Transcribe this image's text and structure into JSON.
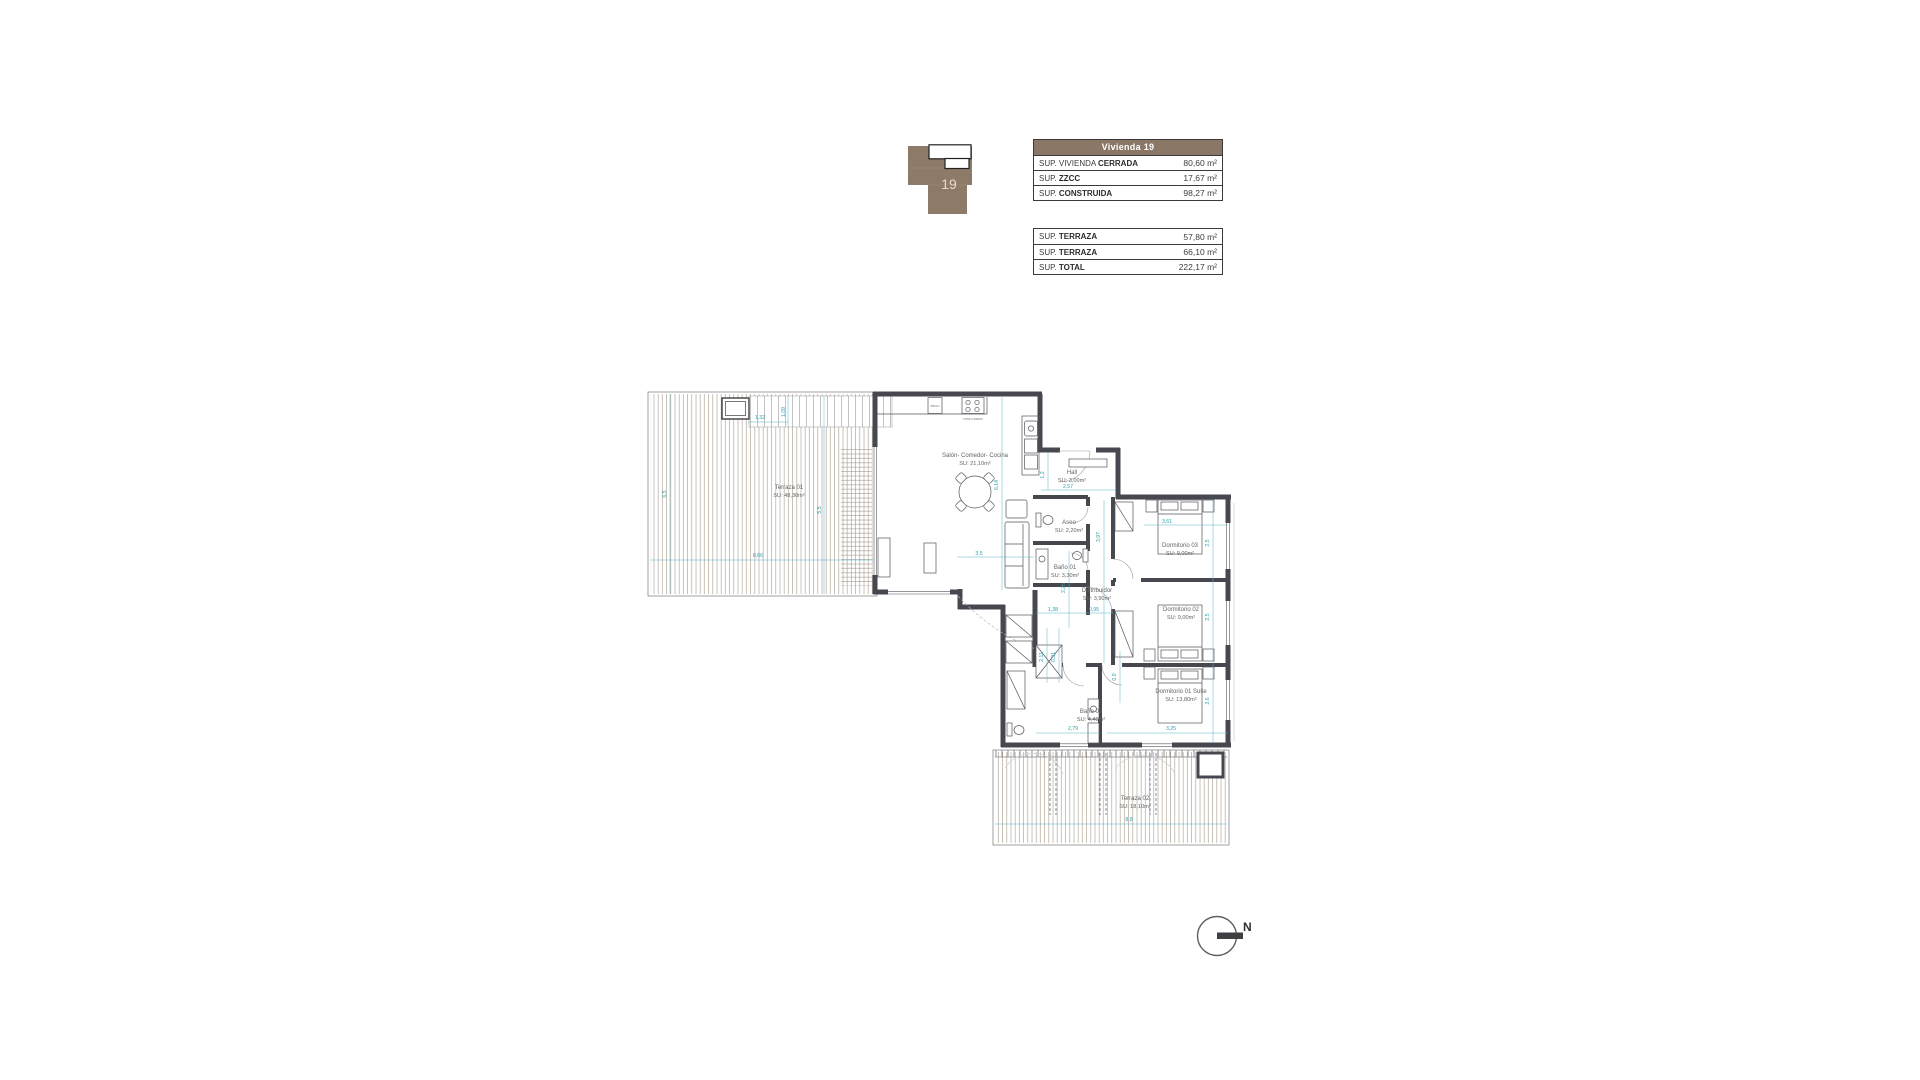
{
  "sheet": {
    "unit_title": "Vivienda 19"
  },
  "key_plan": {
    "unit_number": "19"
  },
  "area_table_1": {
    "header": "Vivienda 19",
    "rows": [
      {
        "label_pre": "SUP. VIVIENDA ",
        "label_bold": "CERRADA",
        "value": "80,60",
        "unit": "m²"
      },
      {
        "label_pre": "SUP. ",
        "label_bold": "ZZCC",
        "value": "17,67",
        "unit": "m²"
      },
      {
        "label_pre": "SUP. ",
        "label_bold": "CONSTRUIDA",
        "value": "98,27",
        "unit": "m²"
      }
    ]
  },
  "area_table_2": {
    "rows": [
      {
        "label_pre": "SUP. ",
        "label_bold": "TERRAZA",
        "value": "57,80",
        "unit": "m²"
      },
      {
        "label_pre": "SUP. ",
        "label_bold": "TERRAZA",
        "value": "66,10",
        "unit": "m²"
      },
      {
        "label_pre": "SUP. ",
        "label_bold": "TOTAL",
        "value": "222,17",
        "unit": "m²"
      }
    ]
  },
  "floor_plan": {
    "rooms": [
      {
        "name": "Terraza 01",
        "area": "SU: 48,30m²",
        "x": 144,
        "y": 106
      },
      {
        "name": "Salón- Comedor- Cocina",
        "area": "SU: 21,10m²",
        "x": 330,
        "y": 74
      },
      {
        "name": "Hall",
        "area": "SU: 3,00m²",
        "x": 427,
        "y": 91
      },
      {
        "name": "Aseo",
        "area": "SU: 2,20m²",
        "x": 424,
        "y": 141
      },
      {
        "name": "Baño 01",
        "area": "SU: 3,30m²",
        "x": 420,
        "y": 186
      },
      {
        "name": "Distribuidor",
        "area": "SU: 3,90m²",
        "x": 452,
        "y": 209
      },
      {
        "name": "Dormitorio 03",
        "area": "SU: 9,00m²",
        "x": 535,
        "y": 164
      },
      {
        "name": "Dormitorio 02",
        "area": "SU: 9,00m²",
        "x": 536,
        "y": 228
      },
      {
        "name": "Dormitorio 01 Suite",
        "area": "SU: 13,80m²",
        "x": 536,
        "y": 310
      },
      {
        "name": "Baño 02",
        "area": "SU: 4,40m²",
        "x": 446,
        "y": 330
      },
      {
        "name": "Terraza 02",
        "area": "SU: 18,10m²",
        "x": 490,
        "y": 417
      }
    ],
    "dimensions": [
      {
        "text": "1,32",
        "x": 115,
        "y": 36,
        "rot": 0
      },
      {
        "text": "1,09",
        "x": 140,
        "y": 29,
        "rot": -90
      },
      {
        "text": "6,5",
        "x": 21,
        "y": 111,
        "rot": -90
      },
      {
        "text": "8,66",
        "x": 113,
        "y": 174,
        "rot": 0
      },
      {
        "text": "5,5",
        "x": 176,
        "y": 127,
        "rot": -90
      },
      {
        "text": "6,14",
        "x": 353,
        "y": 102,
        "rot": -90
      },
      {
        "text": "3,5",
        "x": 334,
        "y": 172,
        "rot": 0
      },
      {
        "text": "1,2",
        "x": 399,
        "y": 92,
        "rot": -90
      },
      {
        "text": "2,57",
        "x": 423,
        "y": 105,
        "rot": 0
      },
      {
        "text": "3,97",
        "x": 455,
        "y": 154,
        "rot": -90
      },
      {
        "text": "2,26",
        "x": 420,
        "y": 205,
        "rot": -90
      },
      {
        "text": "1,38",
        "x": 408,
        "y": 228,
        "rot": 0
      },
      {
        "text": "0,95",
        "x": 449,
        "y": 228,
        "rot": 0
      },
      {
        "text": "2,11",
        "x": 398,
        "y": 274,
        "rot": -90
      },
      {
        "text": "0,91",
        "x": 410,
        "y": 274,
        "rot": -90
      },
      {
        "text": "0,9",
        "x": 471,
        "y": 294,
        "rot": -90
      },
      {
        "text": "2,79",
        "x": 428,
        "y": 347,
        "rot": 0
      },
      {
        "text": "3,25",
        "x": 526,
        "y": 347,
        "rot": 0
      },
      {
        "text": "3,61",
        "x": 522,
        "y": 140,
        "rot": 0
      },
      {
        "text": "2,5",
        "x": 564,
        "y": 160,
        "rot": -90
      },
      {
        "text": "2,5",
        "x": 564,
        "y": 234,
        "rot": -90
      },
      {
        "text": "2,6",
        "x": 564,
        "y": 318,
        "rot": -90
      },
      {
        "text": "8,8",
        "x": 484,
        "y": 438,
        "rot": 0
      }
    ],
    "appliances": [
      "FRIGO",
      "VITRO HORNO"
    ],
    "north_label": "N"
  },
  "colors": {
    "wall": "#474750",
    "dimension_teal": "#2f9fae",
    "header_brown": "#8a7766",
    "icon_brown": "#8d7a68",
    "hatch": "#a79a8b"
  }
}
